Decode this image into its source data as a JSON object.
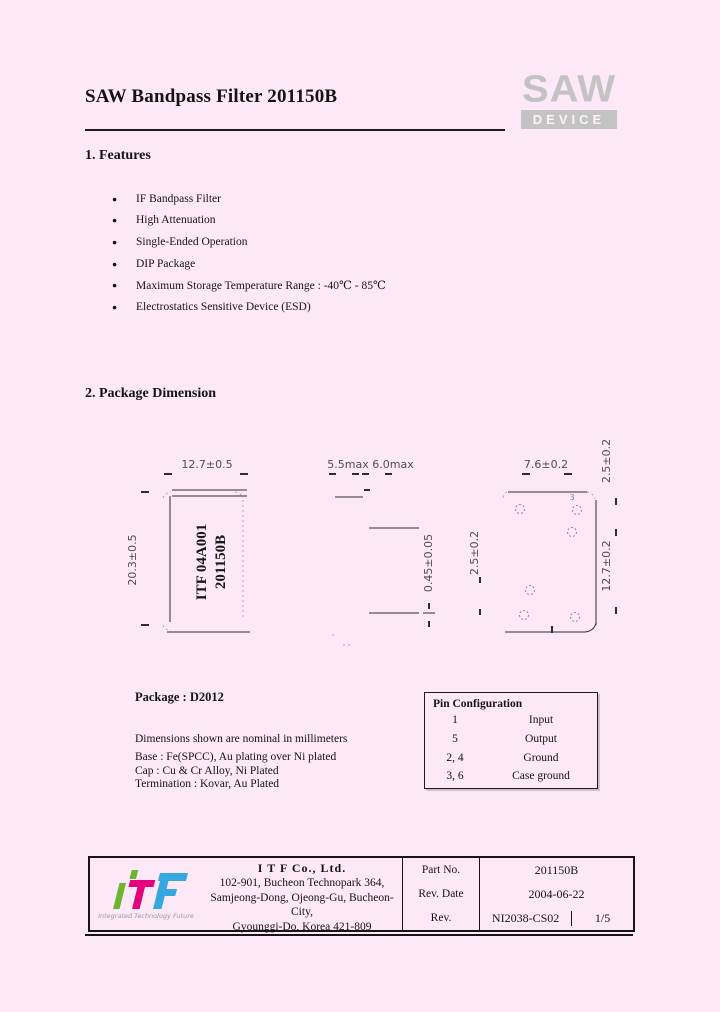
{
  "header": {
    "title": "SAW Bandpass Filter 201150B",
    "logo": {
      "word": "SAW",
      "device": "DEVICE"
    }
  },
  "features": {
    "heading": "1. Features",
    "items": [
      "IF Bandpass Filter",
      "High Attenuation",
      "Single-Ended Operation",
      "DIP Package",
      "Maximum Storage Temperature Range : -40℃ - 85℃",
      "Electrostatics Sensitive Device (ESD)"
    ]
  },
  "package_dimension": {
    "heading": "2. Package Dimension",
    "top_view": {
      "width_dim": "12.7±0.5",
      "height_dim": "20.3±0.5",
      "marking_line1": "ITF 04A001",
      "marking_line2": "201150B"
    },
    "side_view": {
      "cap_height_dim": "5.5max",
      "total_height_dim": "6.0max",
      "lead_thickness_dim": "0.45±0.05",
      "lead_length_dim": "2.5±0.2"
    },
    "bottom_view": {
      "width_dim": "7.6±0.2",
      "pitch_dim": "2.5±0.2",
      "length_dim": "12.7±0.2",
      "pin_label": "3"
    },
    "package_name": "Package : D2012",
    "note_first": "Dimensions shown are nominal in millimeters",
    "notes": [
      "Base : Fe(SPCC), Au plating over Ni plated",
      "Cap : Cu & Cr Alloy, Ni Plated",
      "Termination : Kovar, Au Plated"
    ]
  },
  "pin_configuration": {
    "title": "Pin Configuration",
    "rows": [
      {
        "pins": "1",
        "function": "Input"
      },
      {
        "pins": "5",
        "function": "Output"
      },
      {
        "pins": "2, 4",
        "function": "Ground"
      },
      {
        "pins": "3, 6",
        "function": "Case ground"
      }
    ]
  },
  "footer": {
    "logo": {
      "tagline": "Integrated Technology Future"
    },
    "company": "I T F   Co., Ltd.",
    "address_lines": [
      "102-901, Bucheon Technopark 364,",
      "Samjeong-Dong, Ojeong-Gu, Bucheon-City,",
      "Gyounggi-Do, Korea 421-809"
    ],
    "rows": [
      {
        "label": "Part No.",
        "value": "201150B"
      },
      {
        "label": "Rev. Date",
        "value": "2004-06-22"
      },
      {
        "label": "Rev.",
        "value": "NI2038-CS02",
        "page": "1/5"
      }
    ]
  }
}
